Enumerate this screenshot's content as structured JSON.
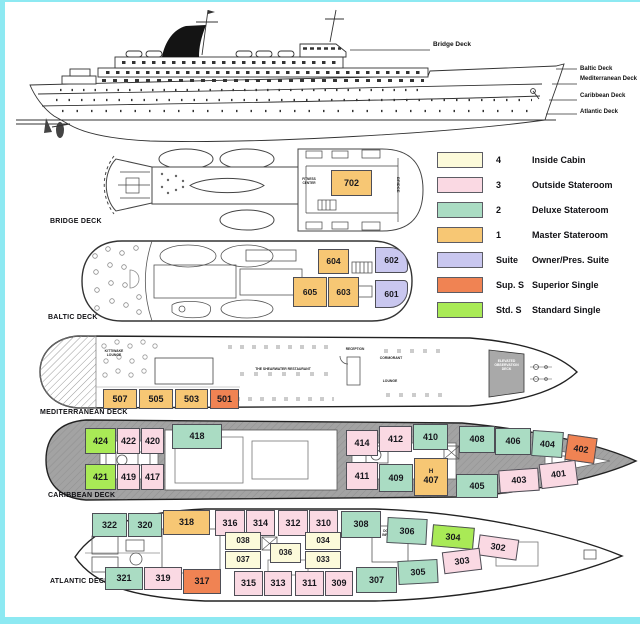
{
  "page": {
    "border_color": "#8de9f2"
  },
  "profile": {
    "pointer_label": "Bridge Deck",
    "stern_labels": [
      {
        "text": "Baltic Deck",
        "x": 580,
        "y": 66
      },
      {
        "text": "Mediterranean Deck",
        "x": 580,
        "y": 76
      },
      {
        "text": "Caribbean Deck",
        "x": 580,
        "y": 93
      },
      {
        "text": "Atlantic Deck",
        "x": 580,
        "y": 109
      }
    ]
  },
  "colors": {
    "inside": "#FCFADA",
    "outside": "#FAD9E3",
    "deluxe": "#AADCC3",
    "master": "#F7C774",
    "suite": "#C9C7EF",
    "superior_single": "#F08353",
    "standard_single": "#A9EA56"
  },
  "legend": {
    "items": [
      {
        "code": "4",
        "label": "Inside Cabin",
        "category": "inside"
      },
      {
        "code": "3",
        "label": "Outside Stateroom",
        "category": "outside"
      },
      {
        "code": "2",
        "label": "Deluxe Stateroom",
        "category": "deluxe"
      },
      {
        "code": "1",
        "label": "Master Stateroom",
        "category": "master"
      },
      {
        "code": "Suite",
        "label": "Owner/Pres. Suite",
        "category": "suite"
      },
      {
        "code": "Sup. S",
        "label": "Superior Single",
        "category": "superior_single"
      },
      {
        "code": "Std. S",
        "label": "Standard Single",
        "category": "standard_single"
      }
    ]
  },
  "decks": [
    {
      "name": "BRIDGE DECK",
      "label": {
        "x": 50,
        "y": 218
      },
      "cabin_fs": 9,
      "venues": [
        {
          "text": "BRIDGE",
          "x": 400,
          "y": 177,
          "w": 12,
          "fs": 4,
          "rot": 90
        },
        {
          "text": "FITNESS CENTER",
          "x": 298,
          "y": 178,
          "w": 22,
          "fs": 3.2
        }
      ],
      "cabins": [
        {
          "id": "702",
          "cat": "master",
          "x": 331,
          "y": 170,
          "w": 41,
          "h": 26
        }
      ]
    },
    {
      "name": "BALTIC DECK",
      "label": {
        "x": 48,
        "y": 314
      },
      "cabin_fs": 8.5,
      "venues": [],
      "cabins": [
        {
          "id": "604",
          "cat": "master",
          "x": 318,
          "y": 249,
          "w": 31,
          "h": 25
        },
        {
          "id": "602",
          "cat": "suite",
          "x": 375,
          "y": 247,
          "w": 33,
          "h": 26,
          "br": "0 18px 4px 0"
        },
        {
          "id": "605",
          "cat": "master",
          "x": 293,
          "y": 277,
          "w": 34,
          "h": 30
        },
        {
          "id": "603",
          "cat": "master",
          "x": 328,
          "y": 277,
          "w": 31,
          "h": 30
        },
        {
          "id": "601",
          "cat": "suite",
          "x": 375,
          "y": 280,
          "w": 33,
          "h": 28,
          "br": "0 4px 18px 0"
        }
      ]
    },
    {
      "name": "MEDITERRANEAN DECK",
      "label": {
        "x": 40,
        "y": 409
      },
      "cabin_fs": 9,
      "venues": [
        {
          "text": "KITTIWAKE LOUNGE",
          "x": 98,
          "y": 349,
          "w": 32,
          "fs": 3.4
        },
        {
          "text": "THE SHEARWATER RESTAURANT",
          "x": 243,
          "y": 367,
          "w": 80,
          "fs": 3.4
        },
        {
          "text": "RECEPTION",
          "x": 342,
          "y": 348,
          "w": 26,
          "fs": 3.2
        },
        {
          "text": "CORMORANT",
          "x": 376,
          "y": 356,
          "w": 30,
          "fs": 3.4
        },
        {
          "text": "LOUNGE",
          "x": 379,
          "y": 379,
          "w": 22,
          "fs": 3.4
        },
        {
          "text": "ELEVATED OBSERVATION DECK",
          "x": 490,
          "y": 359,
          "w": 33,
          "fs": 3.4,
          "light": true
        }
      ],
      "cabins": [
        {
          "id": "507",
          "cat": "master",
          "x": 103,
          "y": 389,
          "w": 34,
          "h": 20
        },
        {
          "id": "505",
          "cat": "master",
          "x": 139,
          "y": 389,
          "w": 34,
          "h": 20
        },
        {
          "id": "503",
          "cat": "master",
          "x": 175,
          "y": 389,
          "w": 33,
          "h": 20
        },
        {
          "id": "501",
          "cat": "superior_single",
          "x": 210,
          "y": 389,
          "w": 29,
          "h": 20
        }
      ]
    },
    {
      "name": "CARIBBEAN DECK",
      "label": {
        "x": 48,
        "y": 492
      },
      "cabin_fs": 9,
      "venues": [],
      "cabins": [
        {
          "id": "424",
          "cat": "standard_single",
          "x": 85,
          "y": 428,
          "w": 31,
          "h": 26
        },
        {
          "id": "422",
          "cat": "outside",
          "x": 117,
          "y": 428,
          "w": 23,
          "h": 26
        },
        {
          "id": "420",
          "cat": "outside",
          "x": 141,
          "y": 428,
          "w": 23,
          "h": 26
        },
        {
          "id": "418",
          "cat": "deluxe",
          "x": 172,
          "y": 424,
          "w": 50,
          "h": 25
        },
        {
          "id": "414",
          "cat": "outside",
          "x": 346,
          "y": 430,
          "w": 32,
          "h": 26
        },
        {
          "id": "412",
          "cat": "outside",
          "x": 379,
          "y": 426,
          "w": 33,
          "h": 26
        },
        {
          "id": "410",
          "cat": "deluxe",
          "x": 413,
          "y": 424,
          "w": 35,
          "h": 26
        },
        {
          "id": "408",
          "cat": "deluxe",
          "x": 459,
          "y": 426,
          "w": 36,
          "h": 27
        },
        {
          "id": "406",
          "cat": "deluxe",
          "x": 495,
          "y": 428,
          "w": 36,
          "h": 27
        },
        {
          "id": "404",
          "cat": "deluxe",
          "x": 532,
          "y": 431,
          "w": 31,
          "h": 26,
          "rot": 4
        },
        {
          "id": "402",
          "cat": "superior_single",
          "x": 566,
          "y": 436,
          "w": 30,
          "h": 26,
          "rot": 8
        },
        {
          "id": "421",
          "cat": "standard_single",
          "x": 85,
          "y": 464,
          "w": 31,
          "h": 26
        },
        {
          "id": "419",
          "cat": "outside",
          "x": 117,
          "y": 464,
          "w": 23,
          "h": 26
        },
        {
          "id": "417",
          "cat": "outside",
          "x": 141,
          "y": 464,
          "w": 23,
          "h": 26
        },
        {
          "id": "411",
          "cat": "outside",
          "x": 346,
          "y": 462,
          "w": 32,
          "h": 28
        },
        {
          "id": "409",
          "cat": "deluxe",
          "x": 379,
          "y": 464,
          "w": 34,
          "h": 28
        },
        {
          "id": "407",
          "cat": "master",
          "x": 414,
          "y": 458,
          "w": 34,
          "h": 38,
          "prefix": "H"
        },
        {
          "id": "405",
          "cat": "deluxe",
          "x": 456,
          "y": 474,
          "w": 42,
          "h": 24
        },
        {
          "id": "403",
          "cat": "outside",
          "x": 499,
          "y": 469,
          "w": 40,
          "h": 23,
          "rot": -4
        },
        {
          "id": "401",
          "cat": "outside",
          "x": 540,
          "y": 462,
          "w": 37,
          "h": 25,
          "rot": -7
        }
      ]
    },
    {
      "name": "ATLANTIC DECK",
      "label": {
        "x": 50,
        "y": 578
      },
      "cabin_fs": 9,
      "venues": [
        {
          "text": "DOCTOR / INFIRMARY",
          "x": 376,
          "y": 530,
          "w": 30,
          "fs": 3.2
        }
      ],
      "cabins": [
        {
          "id": "322",
          "cat": "deluxe",
          "x": 92,
          "y": 513,
          "w": 35,
          "h": 24
        },
        {
          "id": "320",
          "cat": "deluxe",
          "x": 128,
          "y": 513,
          "w": 34,
          "h": 24
        },
        {
          "id": "318",
          "cat": "master",
          "x": 163,
          "y": 510,
          "w": 47,
          "h": 25
        },
        {
          "id": "316",
          "cat": "outside",
          "x": 215,
          "y": 510,
          "w": 30,
          "h": 26
        },
        {
          "id": "314",
          "cat": "outside",
          "x": 246,
          "y": 510,
          "w": 29,
          "h": 26
        },
        {
          "id": "312",
          "cat": "outside",
          "x": 278,
          "y": 510,
          "w": 30,
          "h": 26
        },
        {
          "id": "310",
          "cat": "outside",
          "x": 309,
          "y": 510,
          "w": 29,
          "h": 26
        },
        {
          "id": "308",
          "cat": "deluxe",
          "x": 341,
          "y": 511,
          "w": 40,
          "h": 27
        },
        {
          "id": "306",
          "cat": "deluxe",
          "x": 387,
          "y": 518,
          "w": 40,
          "h": 26,
          "rot": 3
        },
        {
          "id": "304",
          "cat": "standard_single",
          "x": 432,
          "y": 526,
          "w": 42,
          "h": 22,
          "rot": 5
        },
        {
          "id": "302",
          "cat": "outside",
          "x": 478,
          "y": 537,
          "w": 40,
          "h": 21,
          "rot": 8
        },
        {
          "id": "038",
          "cat": "inside",
          "x": 225,
          "y": 532,
          "w": 36,
          "h": 18,
          "fs": 8
        },
        {
          "id": "037",
          "cat": "inside",
          "x": 225,
          "y": 551,
          "w": 36,
          "h": 18,
          "fs": 8
        },
        {
          "id": "036",
          "cat": "inside",
          "x": 270,
          "y": 543,
          "w": 31,
          "h": 20,
          "fs": 8
        },
        {
          "id": "034",
          "cat": "inside",
          "x": 305,
          "y": 532,
          "w": 36,
          "h": 18,
          "fs": 8
        },
        {
          "id": "033",
          "cat": "inside",
          "x": 305,
          "y": 551,
          "w": 36,
          "h": 18,
          "fs": 8
        },
        {
          "id": "321",
          "cat": "deluxe",
          "x": 105,
          "y": 567,
          "w": 38,
          "h": 23
        },
        {
          "id": "319",
          "cat": "outside",
          "x": 144,
          "y": 567,
          "w": 38,
          "h": 23
        },
        {
          "id": "317",
          "cat": "superior_single",
          "x": 183,
          "y": 569,
          "w": 38,
          "h": 25
        },
        {
          "id": "315",
          "cat": "outside",
          "x": 234,
          "y": 571,
          "w": 29,
          "h": 25
        },
        {
          "id": "313",
          "cat": "outside",
          "x": 264,
          "y": 571,
          "w": 28,
          "h": 25
        },
        {
          "id": "311",
          "cat": "outside",
          "x": 295,
          "y": 571,
          "w": 29,
          "h": 25
        },
        {
          "id": "309",
          "cat": "outside",
          "x": 325,
          "y": 571,
          "w": 28,
          "h": 25
        },
        {
          "id": "307",
          "cat": "deluxe",
          "x": 356,
          "y": 567,
          "w": 41,
          "h": 26
        },
        {
          "id": "305",
          "cat": "deluxe",
          "x": 398,
          "y": 560,
          "w": 40,
          "h": 24,
          "rot": -3
        },
        {
          "id": "303",
          "cat": "outside",
          "x": 443,
          "y": 550,
          "w": 38,
          "h": 22,
          "rot": -7
        }
      ]
    }
  ]
}
